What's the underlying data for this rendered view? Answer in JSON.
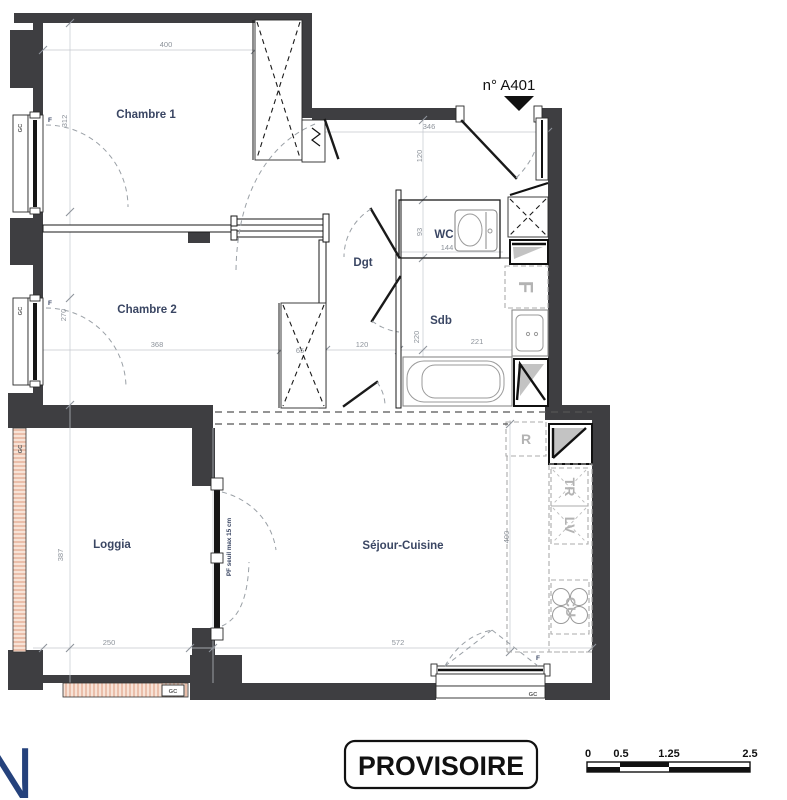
{
  "plan": {
    "unit_label": "n° A401",
    "rooms": {
      "chambre1": "Chambre 1",
      "chambre2": "Chambre 2",
      "wc": "WC",
      "dgt": "Dgt",
      "sdb": "Sdb",
      "loggia": "Loggia",
      "sejour": "Séjour-Cuisine"
    },
    "dims": {
      "c1_w": "400",
      "c1_h": "312",
      "entry_w": "346",
      "entry_d": "120",
      "wc_h": "93",
      "wc_w": "144",
      "c2_h": "270",
      "c2_w": "368",
      "closet_w": "65",
      "hall_w": "120",
      "sdb_h": "220",
      "sdb_w": "221",
      "loggia_h": "387",
      "loggia_w": "250",
      "sejour_h": "400",
      "sejour_w": "572"
    },
    "marks": {
      "f": "F",
      "gc": "GC",
      "pf": "PF seuil max 15 cm",
      "fridge": "F",
      "r": "R",
      "tr": "TR",
      "lv": "LV",
      "cu": "CU"
    }
  },
  "stamp": "PROVISOIRE",
  "scale_bar": {
    "t0": "0",
    "t1": "0.5",
    "t2": "1.25",
    "t3": "2.5"
  },
  "logo_letter": "N",
  "colors": {
    "wall": "#3e3e41",
    "label": "#3a4663",
    "dim": "#8d939b",
    "hatch": "#dd9a7d",
    "logo": "#25427c"
  }
}
